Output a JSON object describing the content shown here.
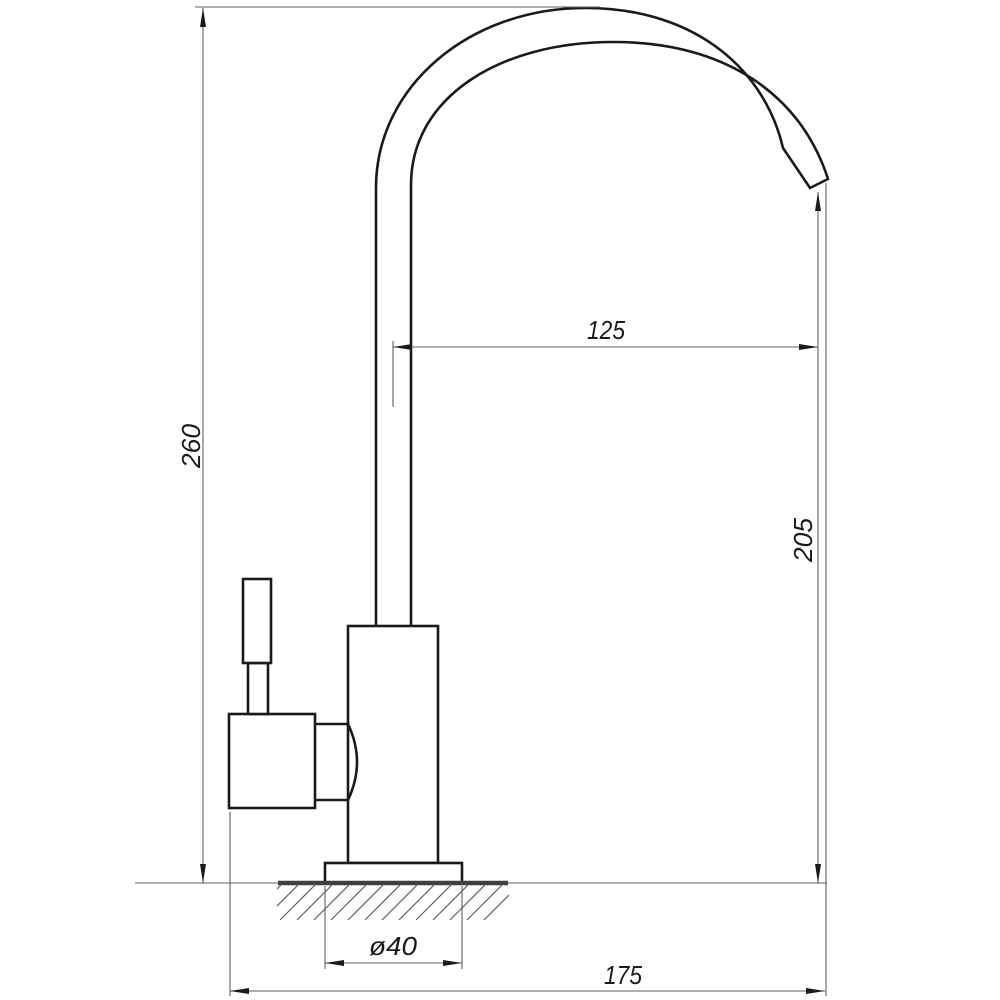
{
  "drawing": {
    "labels": {
      "total_height": "260",
      "spout_reach": "125",
      "outlet_height": "205",
      "base_diameter": "ø40",
      "total_depth": "175"
    },
    "colors": {
      "object_line": "#1a1a1a",
      "dimension_line": "#606060",
      "surface_line": "#3f3f3f",
      "background": "#ffffff"
    }
  }
}
